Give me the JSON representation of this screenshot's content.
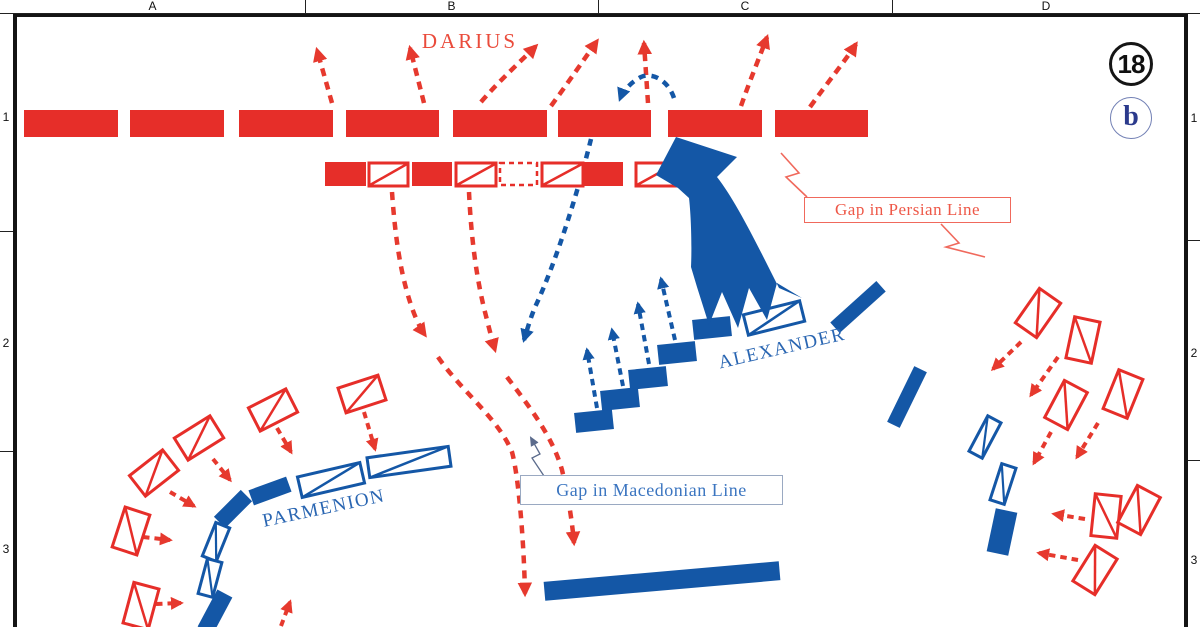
{
  "sheet": {
    "number": "18",
    "letter": "b"
  },
  "grid": {
    "columns": [
      "A",
      "B",
      "C",
      "D"
    ],
    "rows": [
      "1",
      "2",
      "3"
    ]
  },
  "labels": {
    "darius": "DARIUS",
    "alexander": "ALEXANDER",
    "parmenion": "PARMENION",
    "gap_persian": "Gap in Persian Line",
    "gap_macedonian": "Gap in Macedonian Line"
  },
  "colors": {
    "persian_red": "#e62e29",
    "persian_red_light": "#f0695c",
    "macedonian_blue": "#1457a6",
    "macedonian_blue_text": "#2a66b2",
    "badge_navy": "#2b3a8c"
  },
  "icon_legend": {
    "solid_bar": "infantry-unit-icon",
    "rect_with_diagonal": "cavalry-unit-icon",
    "dashed_rect": "gap-in-line-icon",
    "dashed_arrow": "movement-arrow-icon",
    "large_solid_arrow": "charge-arrow-icon"
  }
}
